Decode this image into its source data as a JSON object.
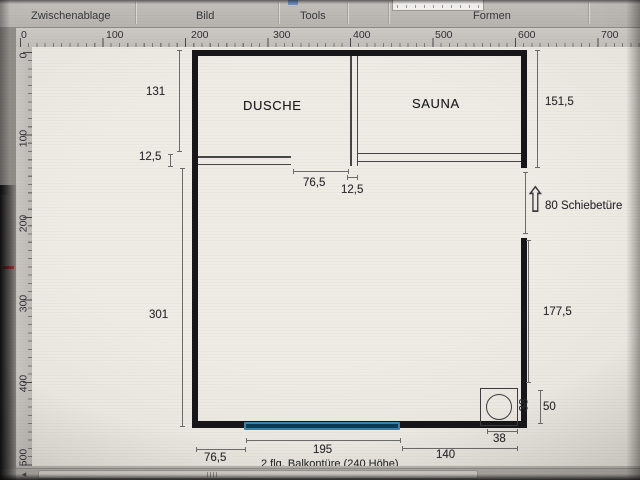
{
  "ribbon": {
    "groups": [
      {
        "label": "Zwischenablage"
      },
      {
        "label": "Bild"
      },
      {
        "label": "Tools"
      },
      {
        "label": "Formen"
      }
    ]
  },
  "rulers": {
    "horizontal": [
      "0",
      "100",
      "200",
      "300",
      "400",
      "500",
      "600",
      "700"
    ],
    "vertical": [
      "0",
      "100",
      "200",
      "300",
      "400",
      "500"
    ]
  },
  "icons": {
    "door_direction_arrow": "⇧",
    "scrollbar_left_arrow": "◂"
  },
  "plan": {
    "rooms": [
      {
        "name": "DUSCHE"
      },
      {
        "name": "SAUNA"
      }
    ],
    "dims": {
      "left_top": "131",
      "left_wall": "12,5",
      "left_main": "301",
      "right_top": "151,5",
      "door_label": "80 Schiebetüre",
      "right_main": "177,5",
      "corner_width": "38",
      "corner_height": "50",
      "opening_top": "76,5",
      "wall_top": "12,5",
      "bottom_left": "76,5",
      "bottom_door": "195",
      "bottom_right": "140",
      "bottom_corner": "38",
      "note": "2 flg. Balkontüre (240 Höhe)"
    },
    "colors": {
      "wall": "#16161a",
      "balcony_door_border": "#3884ab",
      "balcony_door_fill": "#0c3a52"
    }
  }
}
